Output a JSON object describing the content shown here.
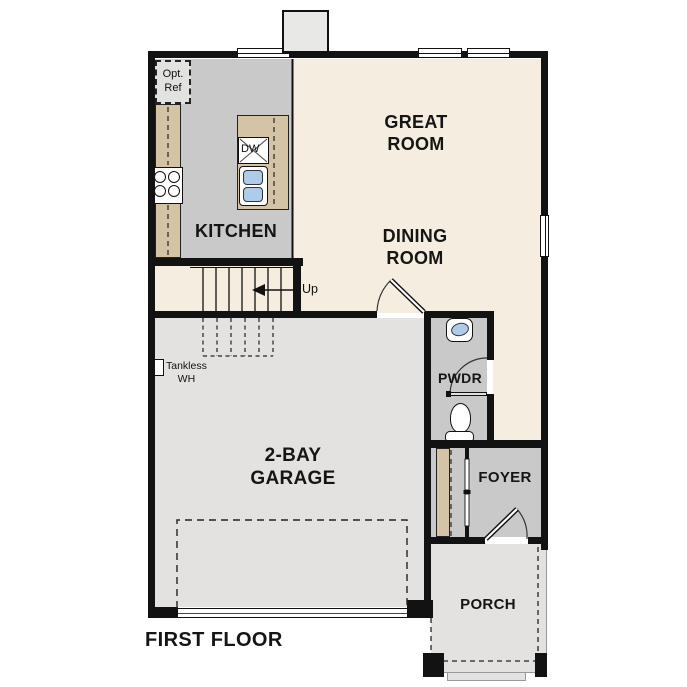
{
  "plan": {
    "title": "FIRST FLOOR",
    "rooms": {
      "great_room": {
        "line1": "GREAT",
        "line2": "ROOM"
      },
      "dining_room": {
        "line1": "DINING",
        "line2": "ROOM"
      },
      "kitchen": {
        "label": "KITCHEN"
      },
      "garage": {
        "line1": "2-BAY",
        "line2": "GARAGE"
      },
      "pwdr": {
        "label": "PWDR"
      },
      "foyer": {
        "label": "FOYER"
      },
      "porch": {
        "label": "PORCH"
      }
    },
    "annotations": {
      "opt_ref": {
        "line1": "Opt.",
        "line2": "Ref"
      },
      "tankless": {
        "line1": "Tankless",
        "line2": "WH"
      },
      "stairs_direction": "Up",
      "dishwasher": "DW"
    },
    "colors": {
      "floor_cream": "#f5ede0",
      "floor_gray": "#c9c9c9",
      "floor_light": "#e3e2e0",
      "counter_tan": "#d5c3a5",
      "wall_black": "#121212",
      "sink_blue": "#aecbe9"
    }
  }
}
